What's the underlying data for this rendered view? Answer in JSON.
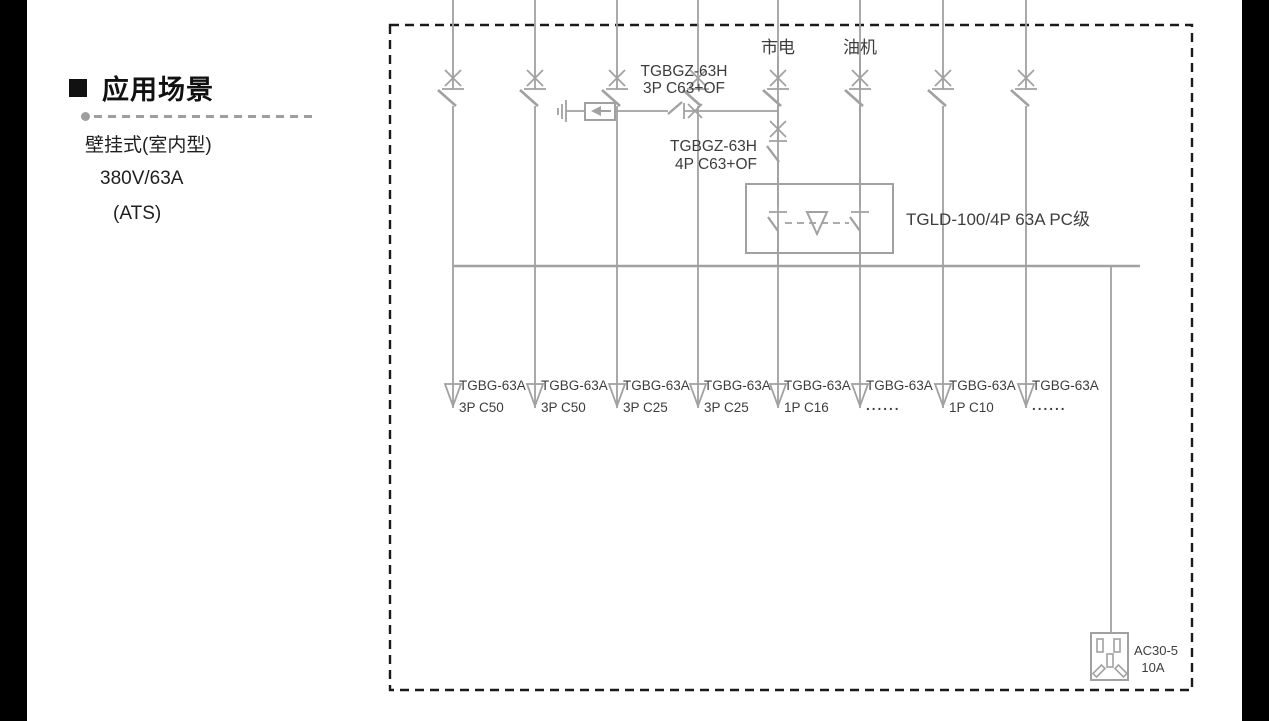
{
  "left_panel": {
    "heading": "应用场景",
    "subtitle_lines": [
      "壁挂式(室内型)",
      "380V/63A",
      "(ATS)"
    ]
  },
  "diagram": {
    "colors": {
      "line": "#a1a1a1",
      "label": "#3d3d3d",
      "border": "#1a1a1a"
    },
    "sources": {
      "mains": "市电",
      "generator": "油机"
    },
    "spd_breaker": {
      "model": "TGBGZ-63H",
      "spec": "3P C63+OF"
    },
    "main_breaker": {
      "model": "TGBGZ-63H",
      "spec": "4P C63+OF"
    },
    "ats": {
      "label": "TGLD-100/4P 63A PC级"
    },
    "branches": [
      {
        "model": "TGBG-63A",
        "spec": "3P C50"
      },
      {
        "model": "TGBG-63A",
        "spec": "3P C50"
      },
      {
        "model": "TGBG-63A",
        "spec": "3P C25"
      },
      {
        "model": "TGBG-63A",
        "spec": "3P C25"
      },
      {
        "model": "TGBG-63A",
        "spec": "1P C16"
      },
      {
        "model": "TGBG-63A",
        "spec": "......"
      },
      {
        "model": "TGBG-63A",
        "spec": "1P C10"
      },
      {
        "model": "TGBG-63A",
        "spec": "......"
      }
    ],
    "socket": {
      "model": "AC30-5",
      "rating": "10A"
    }
  }
}
